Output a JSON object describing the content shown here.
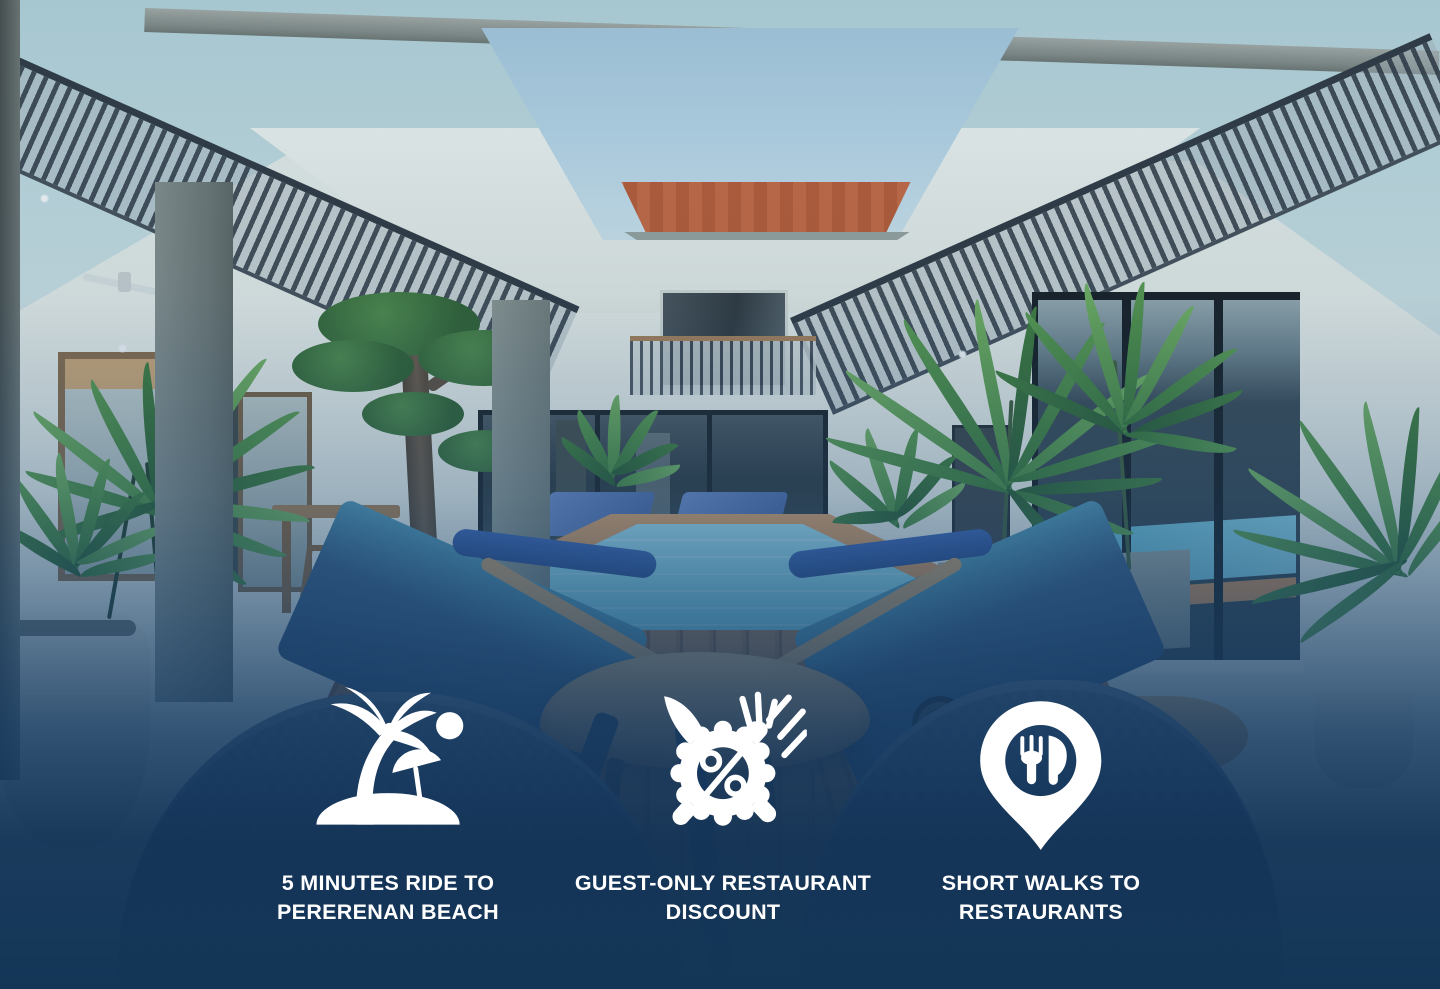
{
  "colors": {
    "overlay-bottom": "#133657",
    "text": "#ffffff",
    "icon": "#ffffff",
    "pool-water": "#84cfe3",
    "pool-rim": "#cf8a50",
    "deck-wood": "#96653f",
    "cushion-blue": "#35597f",
    "plant-green": "#4c8a3f",
    "ceiling": "#c6dde1",
    "sky": "#bcd9e8",
    "roof": "#bd5a30",
    "wall": "#edf0e9"
  },
  "features": [
    {
      "icon": "beach-island-palm-umbrella-icon",
      "line1": "5 MINUTES RIDE TO",
      "line2": "PERERENAN BEACH"
    },
    {
      "icon": "restaurant-discount-percent-icon",
      "line1": "GUEST-ONLY RESTAURANT",
      "line2": "DISCOUNT"
    },
    {
      "icon": "restaurant-location-pin-icon",
      "line1": "SHORT WALKS TO",
      "line2": "RESTAURANTS"
    }
  ]
}
